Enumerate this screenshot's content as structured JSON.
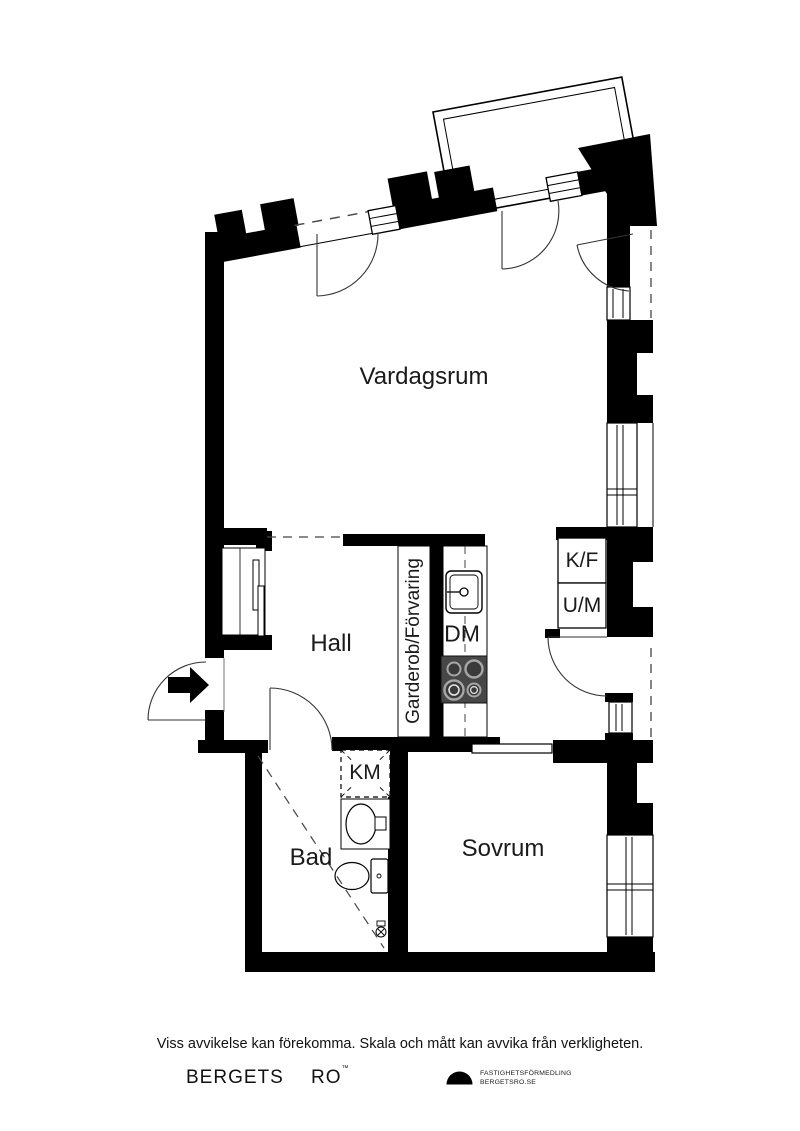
{
  "plan": {
    "rooms": [
      {
        "id": "vardagsrum",
        "label": "Vardagsrum"
      },
      {
        "id": "hall",
        "label": "Hall"
      },
      {
        "id": "bad",
        "label": "Bad"
      },
      {
        "id": "sovrum",
        "label": "Sovrum"
      }
    ],
    "features": {
      "wardrobe": "Garderob/Förvaring",
      "dishwasher": "DM",
      "fridge_freezer": "K/F",
      "oven_microwave": "U/M",
      "washing_machine": "KM"
    }
  },
  "footer": {
    "disclaimer": "Viss avvikelse kan förekomma. Skala och mått kan avvika från verkligheten.",
    "brand_first": "BERGETS",
    "brand_second": "RO",
    "brand_mark": "™",
    "logo_line1": "FASTIGHETSFÖRMEDLING",
    "logo_line2": "BERGETSRO.SE"
  },
  "colors": {
    "walls": "#000000",
    "stove": "#474747",
    "background": "#ffffff"
  }
}
